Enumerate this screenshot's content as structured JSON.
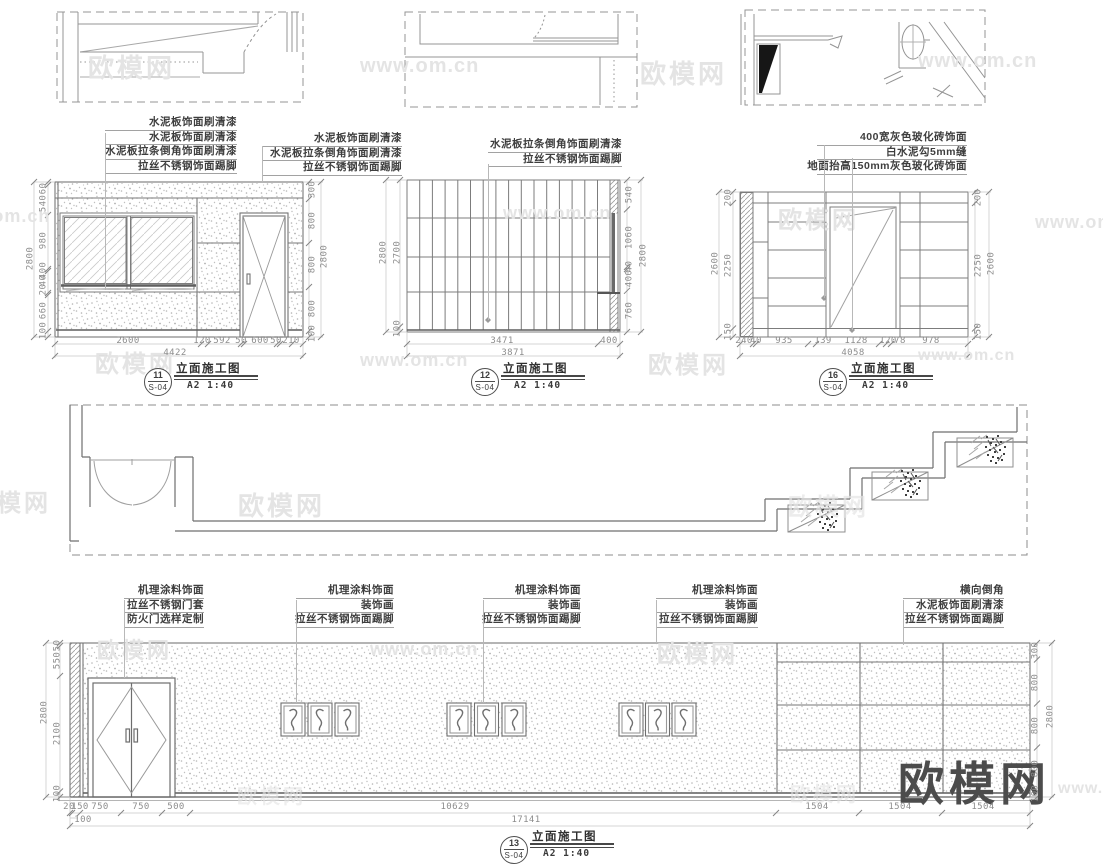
{
  "watermarks": {
    "brand": "欧模网",
    "site": "www.om.cn"
  },
  "e11": {
    "callouts_left": [
      "水泥板饰面刷清漆",
      "水泥板饰面刷清漆",
      "水泥板拉条倒角饰面刷清漆",
      "拉丝不锈钢饰面踢脚"
    ],
    "callouts_right": [
      "水泥板饰面刷清漆",
      "水泥板拉条倒角饰面刷清漆",
      "拉丝不锈钢饰面踢脚"
    ],
    "dims_left": [
      "60",
      "540",
      "980",
      "400",
      "40",
      "20",
      "660",
      "100"
    ],
    "dim_left_total": "2800",
    "dims_right": [
      "300",
      "800",
      "800",
      "800",
      "100"
    ],
    "dim_right_total": "2800",
    "dims_bottom": [
      "2600",
      "120",
      "592",
      "50",
      "600",
      "50",
      "210"
    ],
    "dim_bottom_total": "4422",
    "title": {
      "num": "11",
      "sheet": "S-04",
      "name": "立面施工图",
      "scale": "A2 1:40"
    }
  },
  "e12": {
    "callouts": [
      "水泥板拉条倒角饰面刷清漆",
      "拉丝不锈钢饰面踢脚"
    ],
    "dims_left": [
      "2700",
      "100"
    ],
    "dim_left_total": "2800",
    "dims_right": [
      "540",
      "1060",
      "40",
      "400",
      "760"
    ],
    "dim_right_total": "2800",
    "dims_bottom": [
      "3471",
      "400"
    ],
    "dim_bottom_total": "3871",
    "title": {
      "num": "12",
      "sheet": "S-04",
      "name": "立面施工图",
      "scale": "A2 1:40"
    }
  },
  "e16": {
    "callouts": [
      "400宽灰色玻化砖饰面",
      "白水泥勾5mm缝",
      "地面抬高150mm灰色玻化砖饰面"
    ],
    "dims_left": [
      "200",
      "2250",
      "150"
    ],
    "dim_left_total": "2600",
    "dims_right": [
      "200",
      "2250",
      "150"
    ],
    "dim_right_total": "2600",
    "dims_bottom": [
      "240",
      "40",
      "935",
      "139",
      "1128",
      "120",
      "78",
      "978"
    ],
    "dim_bottom_total": "4058",
    "title": {
      "num": "16",
      "sheet": "S-04",
      "name": "立面施工图",
      "scale": "A2 1:40"
    }
  },
  "e13": {
    "callout_groups": [
      {
        "lines": [
          "机理涂料饰面",
          "拉丝不锈钢门套",
          "防火门选样定制"
        ]
      },
      {
        "lines": [
          "机理涂料饰面",
          "装饰画",
          "拉丝不锈钢饰面踢脚"
        ]
      },
      {
        "lines": [
          "机理涂料饰面",
          "装饰画",
          "拉丝不锈钢饰面踢脚"
        ]
      },
      {
        "lines": [
          "机理涂料饰面",
          "装饰画",
          "拉丝不锈钢饰面踢脚"
        ]
      },
      {
        "lines": [
          "横向倒角",
          "水泥板饰面刷清漆",
          "拉丝不锈钢饰面踢脚"
        ]
      }
    ],
    "dims_left": [
      "50",
      "550",
      "2100",
      "100"
    ],
    "dim_left_total": "2800",
    "dims_right": [
      "300",
      "800",
      "800",
      "800",
      "100"
    ],
    "dim_right_total": "2800",
    "dims_bottom": [
      "20",
      "150",
      "750",
      "750",
      "500",
      "10629",
      "1504",
      "1504",
      "1504"
    ],
    "dims_bottom2": [
      "100",
      "17141"
    ],
    "title": {
      "num": "13",
      "sheet": "S-04",
      "name": "立面施工图",
      "scale": "A2 1:40"
    }
  }
}
